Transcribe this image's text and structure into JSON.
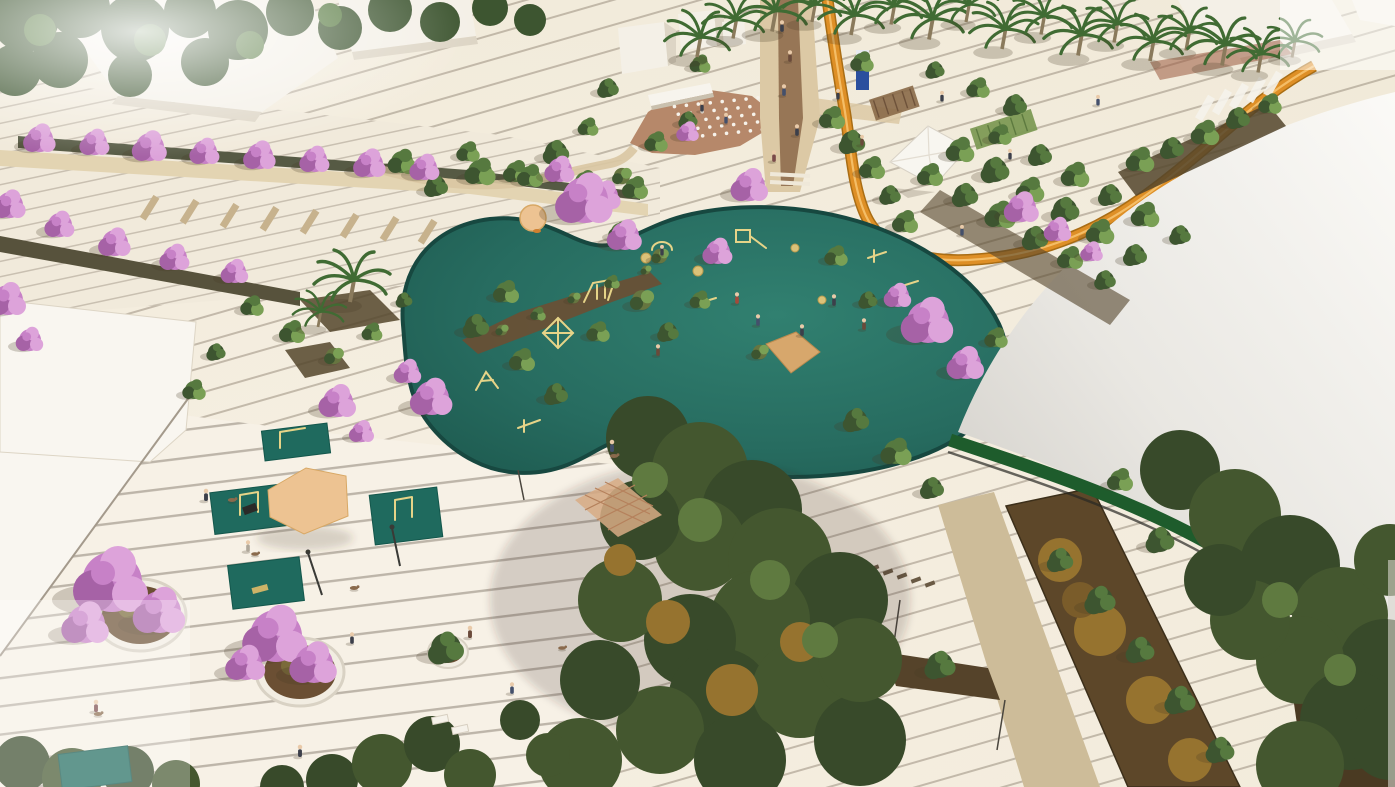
{
  "scene": {
    "title": "Aerial architectural rendering of an urban park plaza with organic teal playground, flowering pink trees, orange cycle loop, amphitheater and white domed pavilion",
    "type": "architectural-render",
    "view": "aerial",
    "elements": [
      {
        "name": "striped-paving-plaza"
      },
      {
        "name": "playground-teal-surface"
      },
      {
        "name": "playground-equipment"
      },
      {
        "name": "pink-blossom-trees"
      },
      {
        "name": "green-trees"
      },
      {
        "name": "palm-trees"
      },
      {
        "name": "orange-bike-loop"
      },
      {
        "name": "domed-sports-pavilion"
      },
      {
        "name": "dome-green-base-band"
      },
      {
        "name": "amphitheater-seating"
      },
      {
        "name": "white-flat-roof-buildings"
      },
      {
        "name": "pedestrian-road"
      },
      {
        "name": "sidewalk-and-crosswalk"
      },
      {
        "name": "exercise-mats"
      },
      {
        "name": "kite-shade-canopy"
      },
      {
        "name": "lattice-shade-canopy"
      },
      {
        "name": "round-tree-planters"
      },
      {
        "name": "white-tent-canopy"
      },
      {
        "name": "pergolas"
      },
      {
        "name": "wayfinding-sign"
      },
      {
        "name": "tan-walkways"
      },
      {
        "name": "mulch-planting-beds"
      },
      {
        "name": "people"
      },
      {
        "name": "dogs"
      }
    ]
  },
  "palette": {
    "paving_cream": "#f3ecdf",
    "deck_cream": "#f7f1e6",
    "white_surface": "#f9f6f0",
    "playground_teal": "#2b7366",
    "playground_rim": "#174840",
    "mat_teal": "#1f6a5e",
    "bike_path_orange": "#de8f26",
    "bike_path_edge": "#a96d14",
    "bike_path_center": "#f4bd66",
    "canopy_tan": "#edc392",
    "picnic_tan": "#d7a76c",
    "play_equipment_khaki": "#e6d488",
    "amphitheater_terracotta": "#b6886a",
    "road_tan": "#dcc9a5",
    "road_brown": "#8b6748",
    "sidewalk_beige": "#e3d4b2",
    "crosswalk_dash": "#c7b28d",
    "soil_brown": "#6b4f33",
    "mulch_gold": "#96732f",
    "bed_dark": "#54452c",
    "tree_green_mid": "#56793f",
    "tree_green_dark": "#3d5530",
    "tree_green_light": "#7aa055",
    "tree_olive": "#667540",
    "canopy_dark1": "#44572f",
    "canopy_dark2": "#384a2a",
    "canopy_light": "#5f7a40",
    "blossom_pink": "#c781c7",
    "blossom_pink_dark": "#a662a6",
    "blossom_pink_light": "#dda3da",
    "palm_green": "#406b33",
    "palm_trunk": "#8a7a5c",
    "dome_white": "#e9e7e2",
    "dome_band_green": "#1e5c2c",
    "building_white": "#f4f0e7",
    "building_shade": "#ddd5c5",
    "wall_white": "#f7f4ed",
    "fence_gray": "#a49a8c",
    "tent_white": "#f8f6f0",
    "pergola_brown": "#8a6a48",
    "pergola_green": "#7d9a55",
    "sign_blue": "#2b4f9e",
    "person_dark": "#3c3f4a",
    "skin": "#e9caa9",
    "dog_brown": "#8a6a4c"
  }
}
